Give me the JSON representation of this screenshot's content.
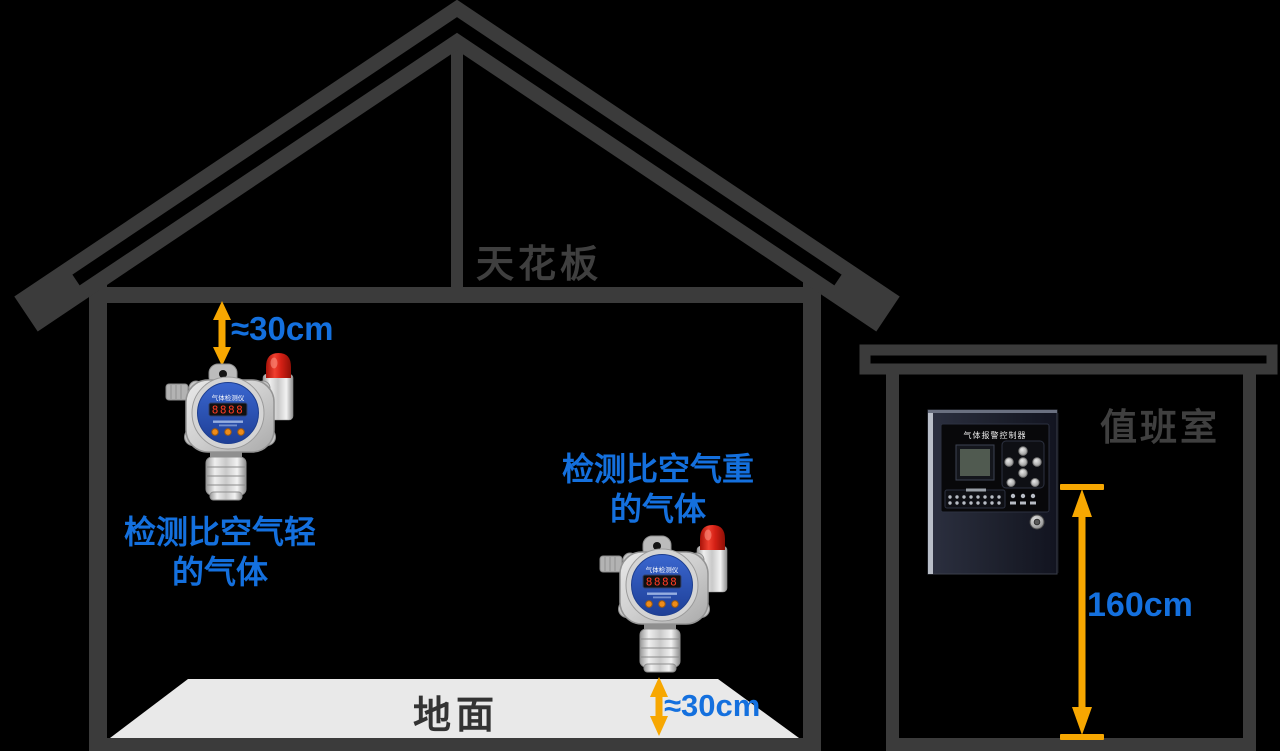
{
  "labels": {
    "ceiling": "天花板",
    "floor": "地面",
    "duty_room": "值班室",
    "top_clearance": "≈30cm",
    "bottom_clearance": "≈30cm",
    "controller_height": "160cm",
    "light_gas_line1": "检测比空气轻",
    "light_gas_line2": "的气体",
    "heavy_gas_line1": "检测比空气重",
    "heavy_gas_line2": "的气体"
  },
  "devices": {
    "detector_title": "气体检测仪",
    "detector_display": "8888",
    "controller_title": "气体报警控制器"
  },
  "colors": {
    "background": "#000000",
    "structure_gray": "#3b3b3b",
    "floor_gray": "#e9e9e9",
    "label_blue": "#1470de",
    "arrow_yellow": "#f7a701",
    "beacon_red": "#d42015",
    "detector_panel_blue": "#2a55b8"
  }
}
